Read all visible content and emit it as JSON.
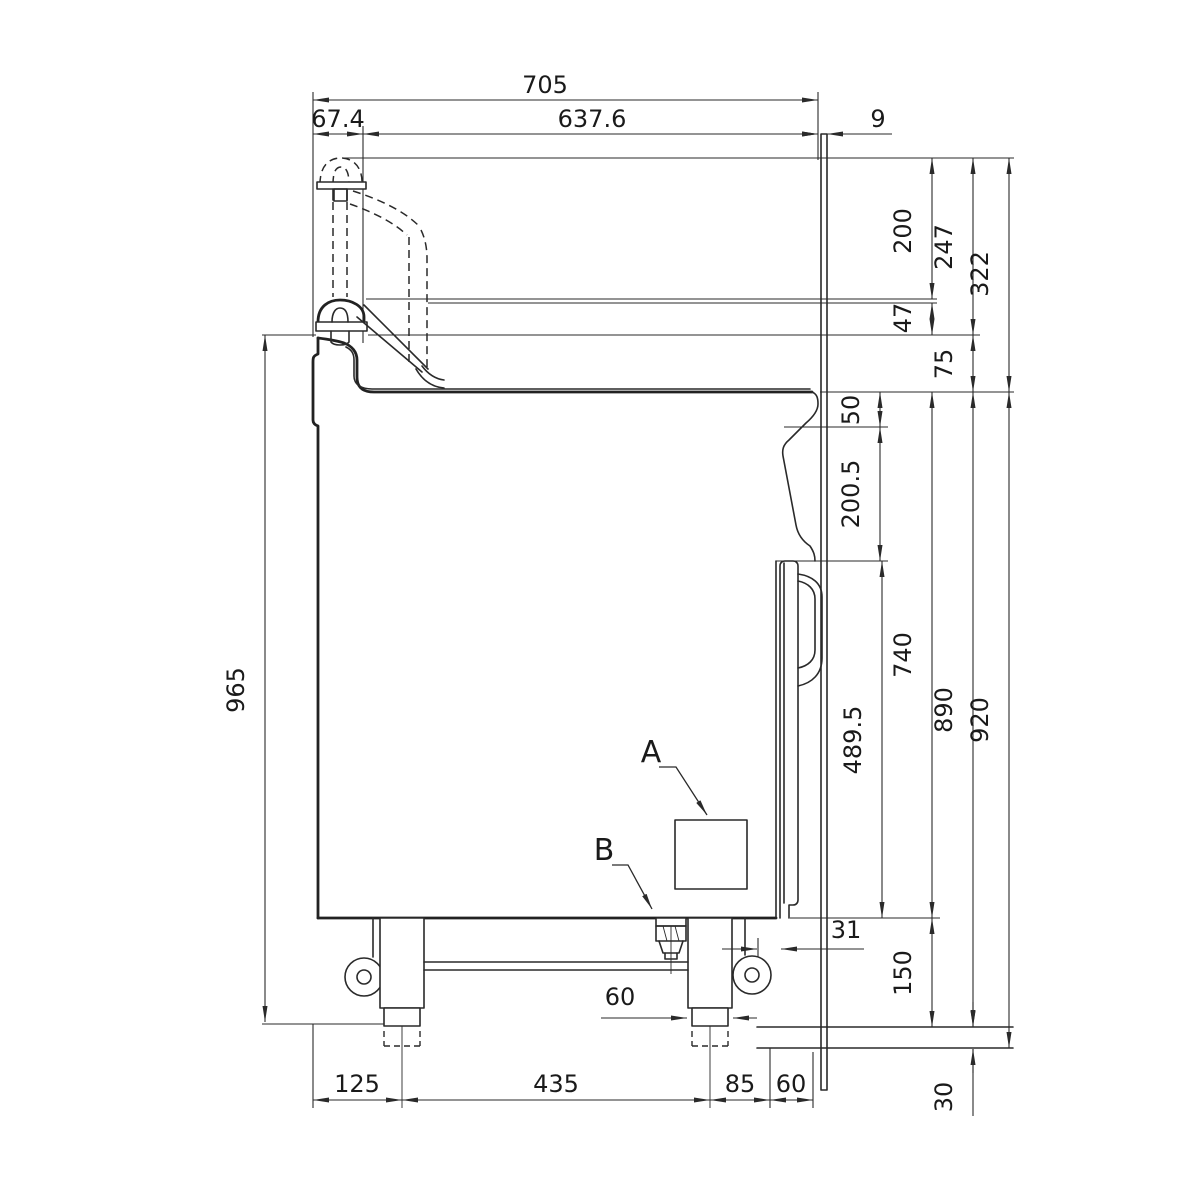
{
  "drawing": {
    "kind": "technical-side-elevation",
    "line_color": "#2a2a2a",
    "background": "#ffffff"
  },
  "dims": {
    "overall_depth": "705",
    "lid_hinge_offset": "67.4",
    "lid_depth": "637.6",
    "rear_gap": "9",
    "open_lid_height": "200",
    "open_to_handle_base": "247",
    "open_above_worktop": "322",
    "handle_step": "47",
    "handle_base_to_worktop": "75",
    "worktop_edge_drop": "50",
    "upper_panel": "200.5",
    "door_panel": "489.5",
    "worktop_to_base": "740",
    "worktop_to_wheel_floor": "890",
    "overall_worktop_height": "920",
    "overall_height": "965",
    "base_clearance": "150",
    "foot_adjustment": "30",
    "rear_clearance": "31",
    "foot_diameter": "60",
    "front_leg_offset": "125",
    "leg_spacing": "435",
    "rear_leg_offset": "85",
    "rear_panel_offset": "60"
  },
  "labels": {
    "detail_a": "A",
    "detail_b": "B"
  }
}
